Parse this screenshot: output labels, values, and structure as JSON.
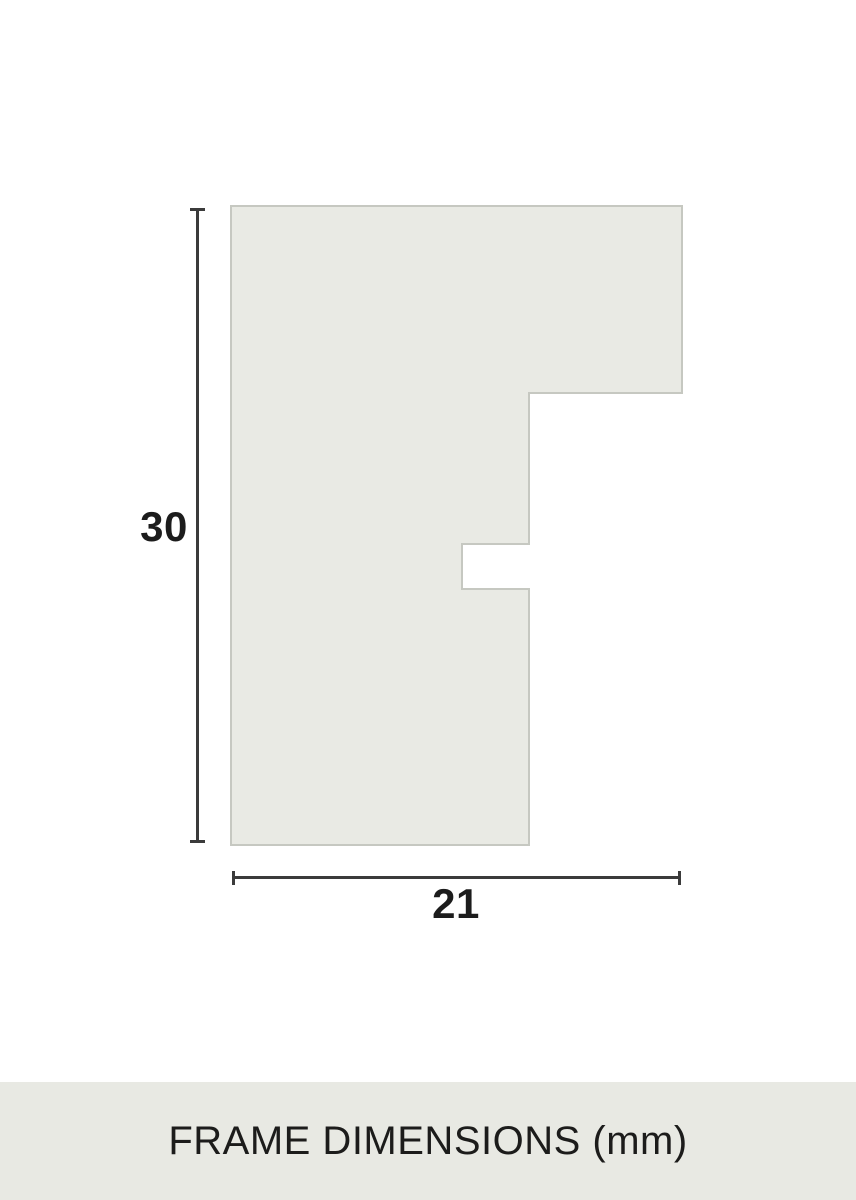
{
  "diagram": {
    "title": "frame moulding profile cross-section",
    "height_mm": "30",
    "width_mm": "21",
    "unit": "mm",
    "profile": {
      "points": "231,206 682,206 682,393 529,393 529,544 462,544 462,589 529,589 529,845 231,845",
      "fill": "#e9eae4",
      "stroke": "#c6c8c1"
    },
    "dimension_line_color": "#3b3b3b",
    "label_color": "#1c1c1c"
  },
  "caption": {
    "text": "FRAME DIMENSIONS (mm)",
    "background": "#e8e9e3",
    "color": "#1c1c1b"
  }
}
